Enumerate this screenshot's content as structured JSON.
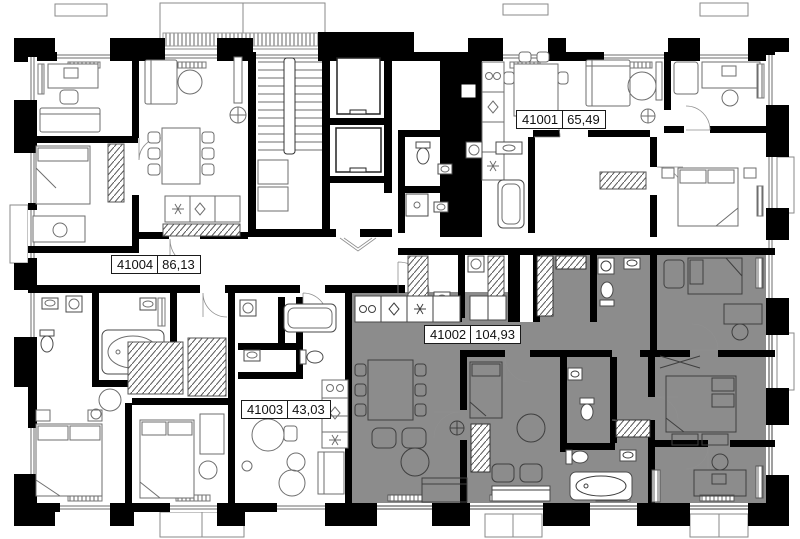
{
  "units": [
    {
      "id": "41001",
      "area": "65,49",
      "highlighted": false
    },
    {
      "id": "41002",
      "area": "104,93",
      "highlighted": true
    },
    {
      "id": "41003",
      "area": "43,03",
      "highlighted": false
    },
    {
      "id": "41004",
      "area": "86,13",
      "highlighted": false
    }
  ],
  "colors": {
    "wall": "#000000",
    "line": "#6e6e6e",
    "line_dark": "#3f3f3f",
    "highlight": "#8c8c8c",
    "bg": "#ffffff"
  }
}
